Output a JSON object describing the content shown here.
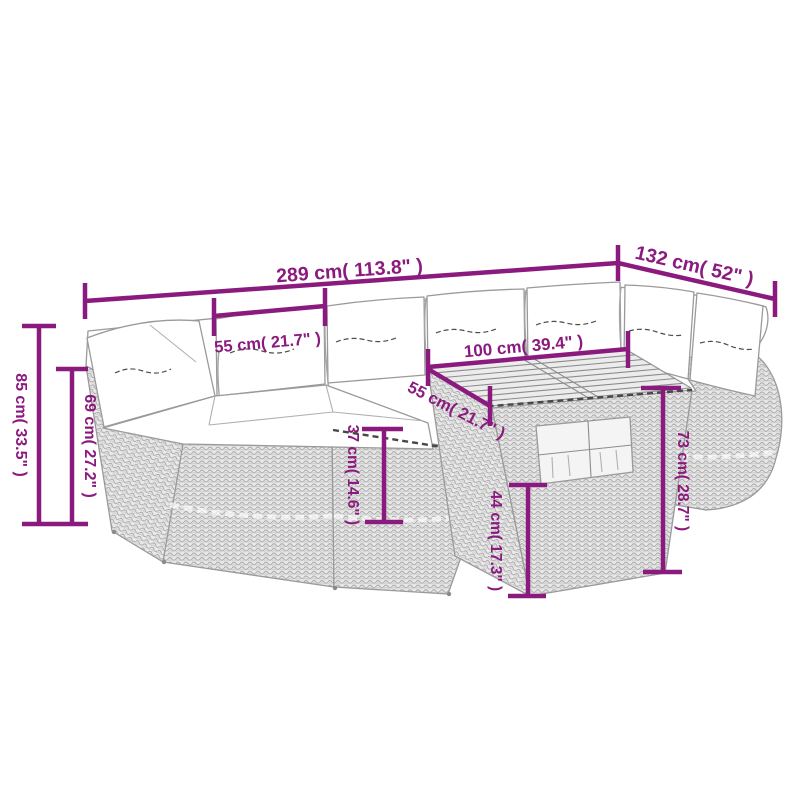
{
  "diagram": {
    "title": "garden-furniture-set-dimension-diagram",
    "background_color": "#ffffff",
    "dimension_color": "#8B1A7E",
    "lineart_color": "#9a9a9a"
  },
  "dimensions": {
    "overall_width": {
      "label": "289 cm( 113.8\" )",
      "cm": "289",
      "inches": "113.8"
    },
    "overall_depth": {
      "label": "132 cm( 52\" )",
      "cm": "132",
      "inches": "52"
    },
    "seat_width": {
      "label": "55 cm( 21.7\" )",
      "cm": "55",
      "inches": "21.7"
    },
    "table_length": {
      "label": "100 cm( 39.4\" )",
      "cm": "100",
      "inches": "39.4"
    },
    "table_depth": {
      "label": "55 cm( 21.7\" )",
      "cm": "55",
      "inches": "21.7"
    },
    "back_height": {
      "label": "85 cm( 33.5\" )",
      "cm": "85",
      "inches": "33.5"
    },
    "arm_height": {
      "label": "69 cm( 27.2\" )",
      "cm": "69",
      "inches": "27.2"
    },
    "seat_height": {
      "label": "37 cm( 14.6\" )",
      "cm": "37",
      "inches": "14.6"
    },
    "shelf_height": {
      "label": "44 cm( 17.3\" )",
      "cm": "44",
      "inches": "17.3"
    },
    "table_height": {
      "label": "73 cm( 28.7\" )",
      "cm": "73",
      "inches": "28.7"
    }
  }
}
